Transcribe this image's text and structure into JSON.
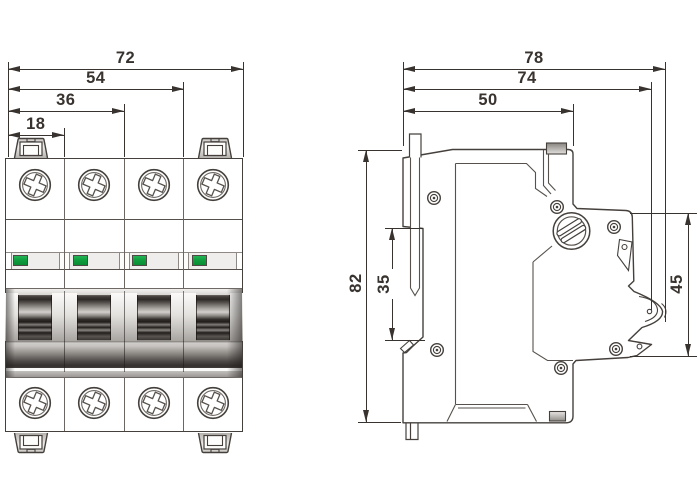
{
  "drawing": {
    "type": "dimensional drawing, 4-pole miniature circuit breaker (front view and side view)",
    "dimensions": {
      "front_total_width": "72",
      "front_three_pole": "54",
      "front_two_pole": "36",
      "front_pole_width": "18",
      "side_total_depth": "78",
      "side_depth_no_clip": "74",
      "side_base_depth": "50",
      "side_height": "82",
      "side_din_recess": "35",
      "side_front_height": "45"
    },
    "colors": {
      "outline": "#45403c",
      "dimension": "#38332f",
      "indicator_green": "#0f9e3e",
      "background": "#ffffff"
    }
  }
}
